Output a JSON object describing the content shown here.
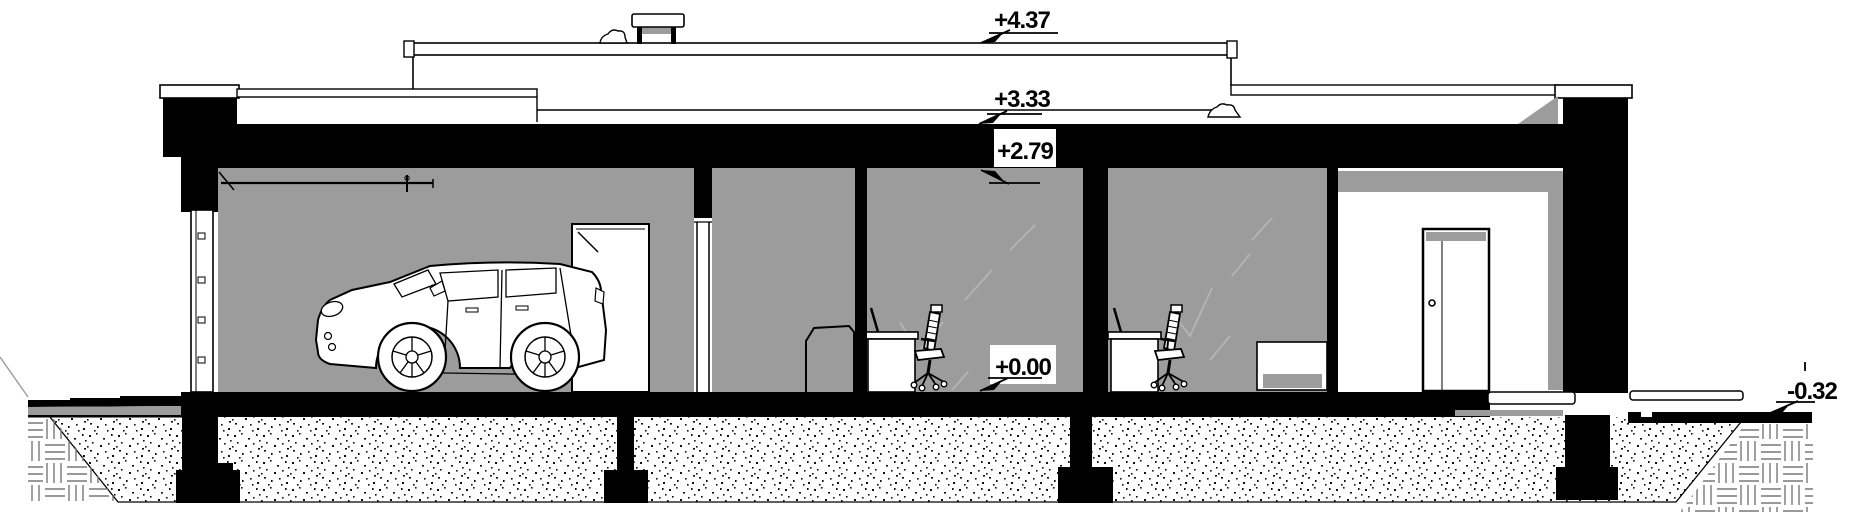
{
  "drawing": {
    "title": "single-storey house cross-section with garage",
    "levels": {
      "roof_high": "+4.37",
      "roof_low": "+3.33",
      "ceiling": "+2.79",
      "floor": "+0.00",
      "ground_outside": "-0.32"
    },
    "colors": {
      "wall_black": "#000000",
      "interior_gray": "#9c9c9c",
      "shadow_gray": "#9c9c9c",
      "faint_gray": "#b3b3b3",
      "hatch_gray": "#777777",
      "paper_white": "#ffffff"
    }
  }
}
